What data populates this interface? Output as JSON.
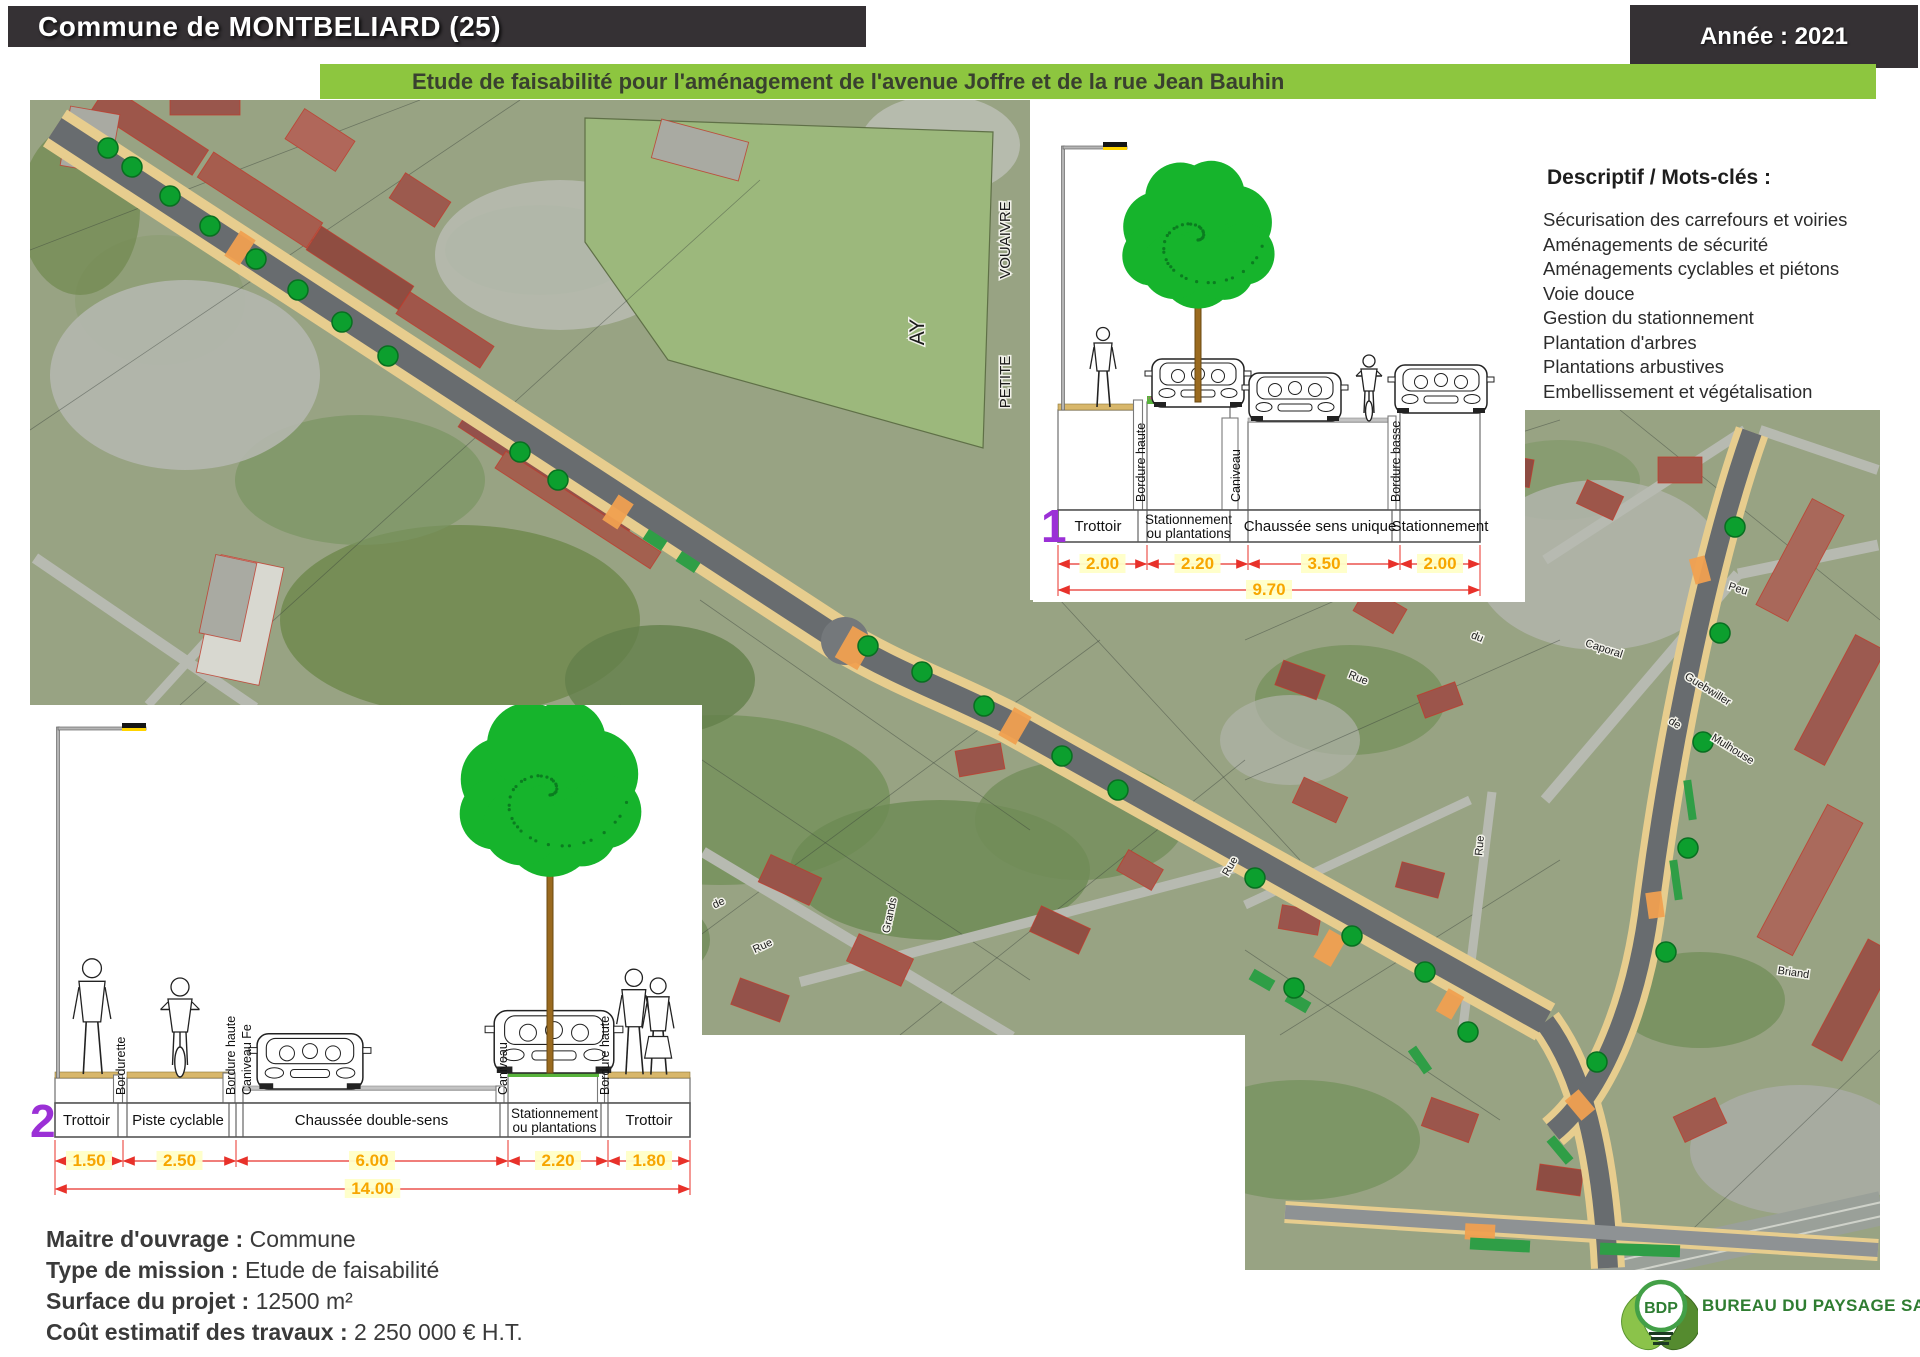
{
  "header": {
    "title": "Commune de MONTBELIARD (25)",
    "year_label": "Année : 2021"
  },
  "banner": {
    "title": "Etude de faisabilité pour l'aménagement de l'avenue Joffre et de la rue Jean Bauhin"
  },
  "descriptif": {
    "title": "Descriptif / Mots-clés :",
    "items": [
      "Sécurisation des carrefours et voiries",
      "Aménagements de sécurité",
      "Aménagements cyclables et piétons",
      "Voie douce",
      "Gestion du stationnement",
      "Plantation d'arbres",
      "Plantations arbustives",
      "Embellissement et végétalisation"
    ]
  },
  "sections": [
    {
      "number": "1",
      "cells": [
        {
          "label": "Trottoir",
          "dim": "2.00"
        },
        {
          "label": "Stationnement ou plantations",
          "dim": "2.20"
        },
        {
          "label": "Chaussée sens unique",
          "dim": "3.50"
        },
        {
          "label": "Stationnement",
          "dim": "2.00"
        }
      ],
      "curb_labels": [
        "Bordure haute",
        "Caniveau",
        "Bordure basse"
      ],
      "total": "9.70"
    },
    {
      "number": "2",
      "cells": [
        {
          "label": "Trottoir",
          "dim": "1.50"
        },
        {
          "label": "Piste cyclable",
          "dim": "2.50"
        },
        {
          "label": "Chaussée double-sens",
          "dim": "6.00"
        },
        {
          "label": "Stationnement ou plantations",
          "dim": "2.20"
        },
        {
          "label": "Trottoir",
          "dim": "1.80"
        }
      ],
      "curb_labels": [
        "Bordurette",
        "Bordure haute",
        "Caniveau Fe",
        "Caniveau",
        "Bordure haute"
      ],
      "total": "14.00"
    }
  ],
  "project_info": {
    "lines": [
      {
        "label": "Maitre d'ouvrage :",
        "value": "Commune"
      },
      {
        "label": "Type de mission :",
        "value": "Etude de faisabilité"
      },
      {
        "label": "Surface du projet :",
        "value": "12500 m²"
      },
      {
        "label": "Coût estimatif des travaux :",
        "value": "2 250 000 € H.T."
      }
    ]
  },
  "logo": {
    "abbr": "BDP",
    "name": "BUREAU DU PAYSAGE SAS"
  },
  "map_labels": [
    {
      "text": "VOUAIVRE",
      "x": 1010,
      "y": 240,
      "rot": -90,
      "size": 15
    },
    {
      "text": "PETITE",
      "x": 1010,
      "y": 382,
      "rot": -90,
      "size": 15
    },
    {
      "text": "AY",
      "x": 924,
      "y": 332,
      "rot": -90,
      "size": 21
    },
    {
      "text": "Jardins",
      "x": 615,
      "y": 800,
      "rot": -22,
      "size": 11
    },
    {
      "text": "Rue",
      "x": 598,
      "y": 878,
      "rot": -22,
      "size": 11
    },
    {
      "text": "Jean",
      "x": 657,
      "y": 886,
      "rot": -80,
      "size": 11
    },
    {
      "text": "Grands",
      "x": 893,
      "y": 916,
      "rot": -78,
      "size": 11
    },
    {
      "text": "de",
      "x": 720,
      "y": 906,
      "rot": -25,
      "size": 11
    },
    {
      "text": "Rue",
      "x": 764,
      "y": 949,
      "rot": -25,
      "size": 11
    },
    {
      "text": "du",
      "x": 1476,
      "y": 640,
      "rot": 22,
      "size": 11
    },
    {
      "text": "Rue",
      "x": 1357,
      "y": 681,
      "rot": 22,
      "size": 11
    },
    {
      "text": "Rue",
      "x": 1483,
      "y": 846,
      "rot": -85,
      "size": 11
    },
    {
      "text": "Peu",
      "x": 1737,
      "y": 592,
      "rot": 18,
      "size": 11
    },
    {
      "text": "Caporal",
      "x": 1603,
      "y": 652,
      "rot": 18,
      "size": 11
    },
    {
      "text": "Guebwiller",
      "x": 1706,
      "y": 692,
      "rot": 32,
      "size": 11
    },
    {
      "text": "de",
      "x": 1673,
      "y": 726,
      "rot": 32,
      "size": 11
    },
    {
      "text": "Mulhouse",
      "x": 1731,
      "y": 752,
      "rot": 32,
      "size": 11
    },
    {
      "text": "Rue",
      "x": 1233,
      "y": 868,
      "rot": -60,
      "size": 11
    },
    {
      "text": "Briand",
      "x": 1793,
      "y": 976,
      "rot": 8,
      "size": 11
    }
  ],
  "colors": {
    "header_bg": "#353134",
    "banner_bg": "#8dc63f",
    "banner_text": "#39402f",
    "accent_purple": "#9b30d6",
    "dim_orange": "#f7a600",
    "dim_red": "#e8312a",
    "logo_green": "#2f7d31",
    "tree_green": "#0c9f2e"
  }
}
